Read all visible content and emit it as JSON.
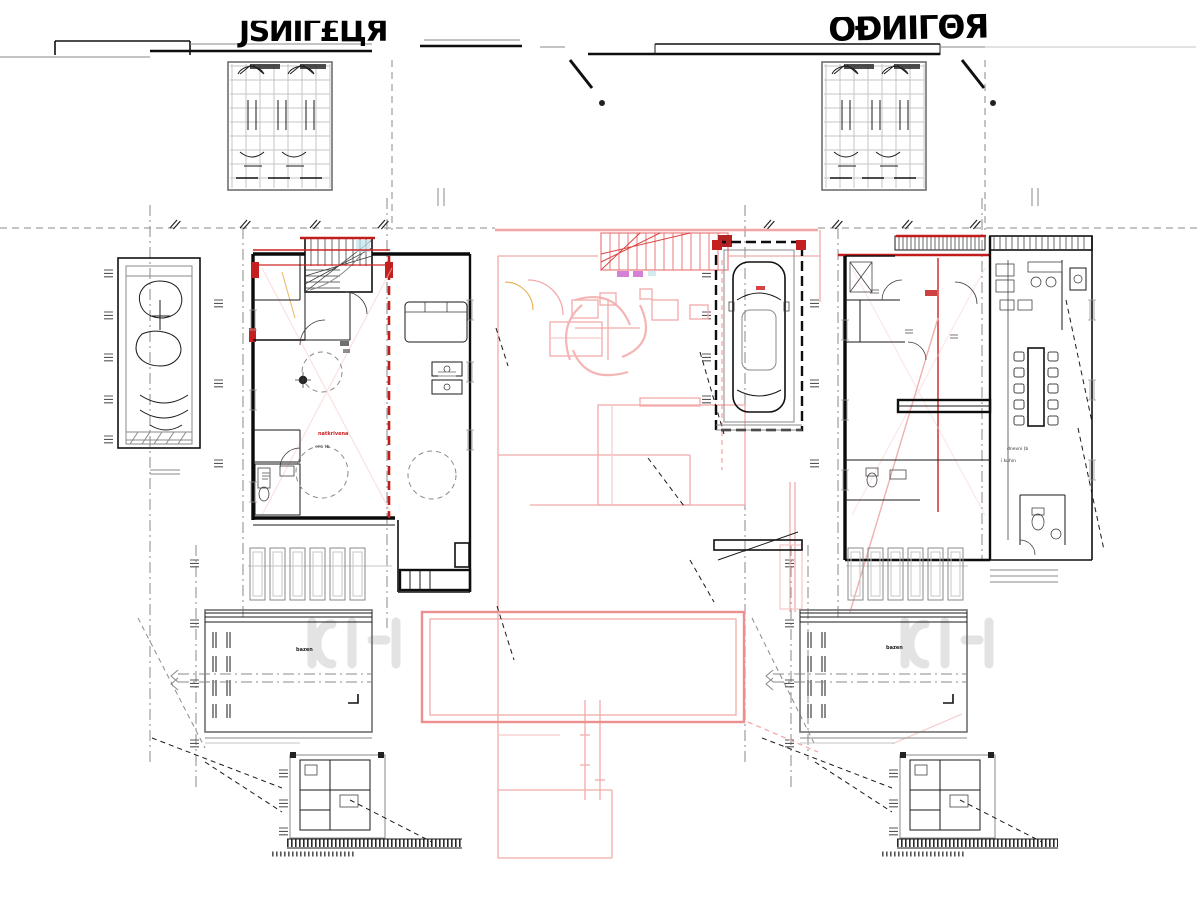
{
  "titles": {
    "left": "ЈЅЙІΓ£ЦЯ",
    "right": "ÒÐЍЇΓΘЯ"
  },
  "labels": {
    "terrace_red": "natkrivena",
    "terrace_sub": "eno tb",
    "pool_left": "bazen",
    "pool_right": "bazen",
    "living": "dnevni (b",
    "kitchen": "i kuhin"
  },
  "colors": {
    "ink": "#1a1a1a",
    "gray": "#8a8a8a",
    "light_gray": "#c6c6c6",
    "red": "#cc2222",
    "salmon": "#ee8f8f",
    "pink": "#f2aaaa",
    "orange": "#e8a33c",
    "magenta": "#c556c5",
    "cyan": "#bfe4ec"
  }
}
